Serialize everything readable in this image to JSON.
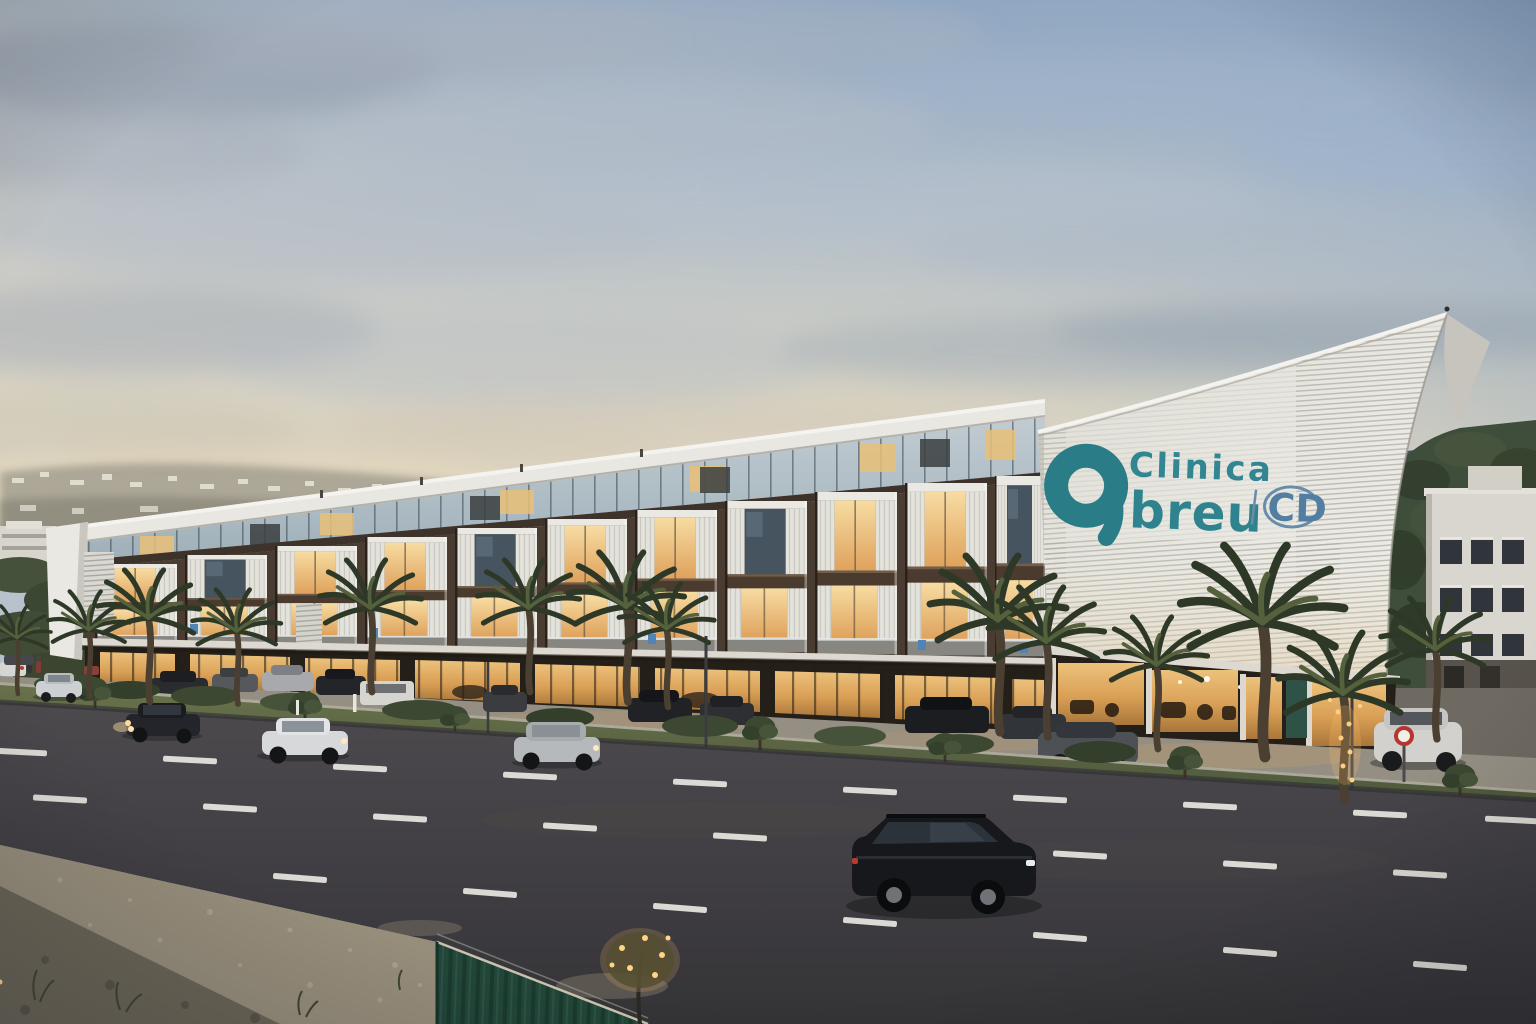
{
  "scene": {
    "description": "Modern clinic building (Clinica Abreu) at dusk, street view with palm trees, traffic and construction foreground",
    "time_of_day": "dusk"
  },
  "sign": {
    "logo_letter": "a",
    "line1": "Clinica",
    "line2": "breu",
    "badge": "CD"
  },
  "palette": {
    "brand_teal": "#2a7d87",
    "badge_blue": "#527ea2",
    "sail_white": "#e7e5de",
    "facade_brown": "#50412f",
    "window_glow": "#f0c87c",
    "sky_top": "#8ea6c2",
    "sky_horizon": "#ecdfc4",
    "road_asphalt": "#434146",
    "grass_green": "#5a6742",
    "fence_green": "#224639",
    "dirt_ground": "#877e6e"
  }
}
